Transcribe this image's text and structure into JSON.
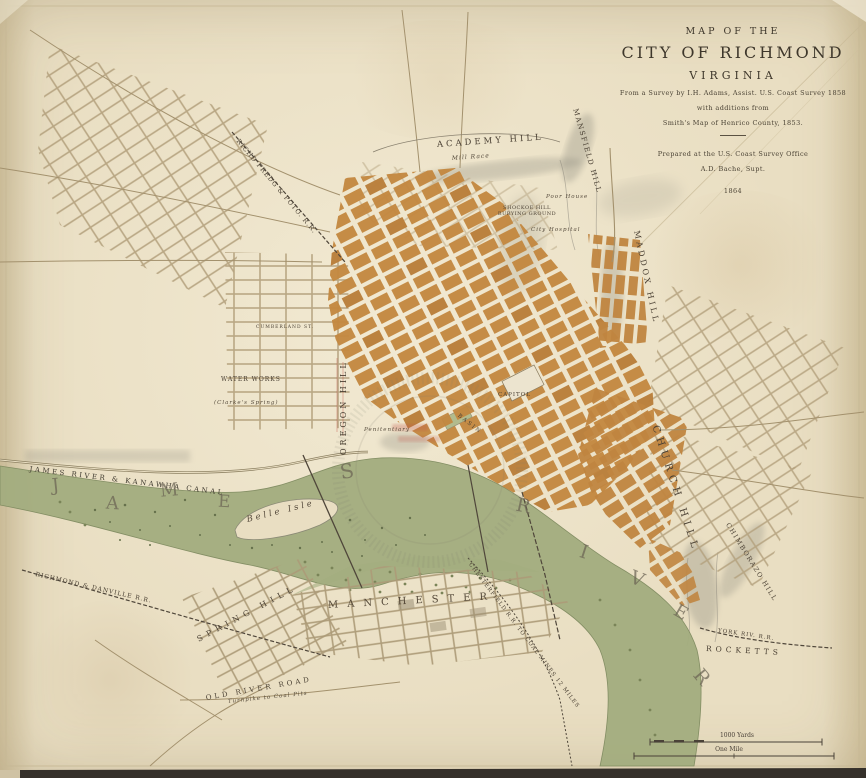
{
  "map": {
    "title_block": {
      "kicker": "MAP OF THE",
      "title": "CITY OF RICHMOND",
      "subtitle": "VIRGINIA",
      "survey_line": "From a Survey by I.H. Adams, Assist. U.S. Coast Survey 1858",
      "additions_line1": "with additions from",
      "additions_line2": "Smith's Map of Henrico County, 1853.",
      "prepared_line1": "Prepared at the U.S. Coast Survey Office",
      "prepared_line2": "A.D. Bache, Supt.",
      "year": "1864"
    },
    "scale_bar": {
      "yards": "1000 Yards",
      "mile": "One Mile"
    },
    "labels": {
      "academy_hill": "ACADEMY HILL",
      "mansfield_hill": "MANSFIELD HILL",
      "mill_race": "Mill Race",
      "rfp_railroad": "RICHD FREDG & POTO. R.R.",
      "shockoe_cemetery": "SHOCKOE HILL BURYING GROUND",
      "poor_house": "Poor House",
      "city_hospital": "City Hospital",
      "maddox_hill": "MADDOX HILL",
      "church_hill": "CHURCH HILL",
      "chimborazo_hill": "CHIMBORAZO HILL",
      "rocketts": "ROCKETTS",
      "york_river_rr": "YORK RIV. R.R.",
      "oregon_hill": "OREGON HILL",
      "water_works": "WATER WORKS",
      "clarkes_spring": "(Clarke's Spring)",
      "penitentiary": "Penitentiary",
      "capitol": "CAPITOL",
      "basin": "BASIN",
      "canal": "JAMES RIVER & KANAWHA CANAL",
      "belle_isle": "Belle Isle",
      "manchester": "MANCHESTER",
      "spring_hill": "SPRING HILL",
      "old_river_road": "OLD RIVER ROAD",
      "rd_railroad": "RICHMOND & DANVILLE R.R.",
      "chesterfield_rr": "CHESTERFIELD R.R. TO COAL MINES 12 MILES",
      "turnpike_coal": "Turnpike to Coal Pits",
      "cumberland_st": "CUMBERLAND ST."
    },
    "river_letters": [
      "J",
      "A",
      "M",
      "E",
      "S",
      "R",
      "I",
      "V",
      "E",
      "R"
    ],
    "colors": {
      "parchment": "#e9dec2",
      "built_blocks": "#c3873f",
      "river_green": "#a3ad7f",
      "ink": "#4b4134",
      "stamp_red": "#c2574a"
    }
  }
}
